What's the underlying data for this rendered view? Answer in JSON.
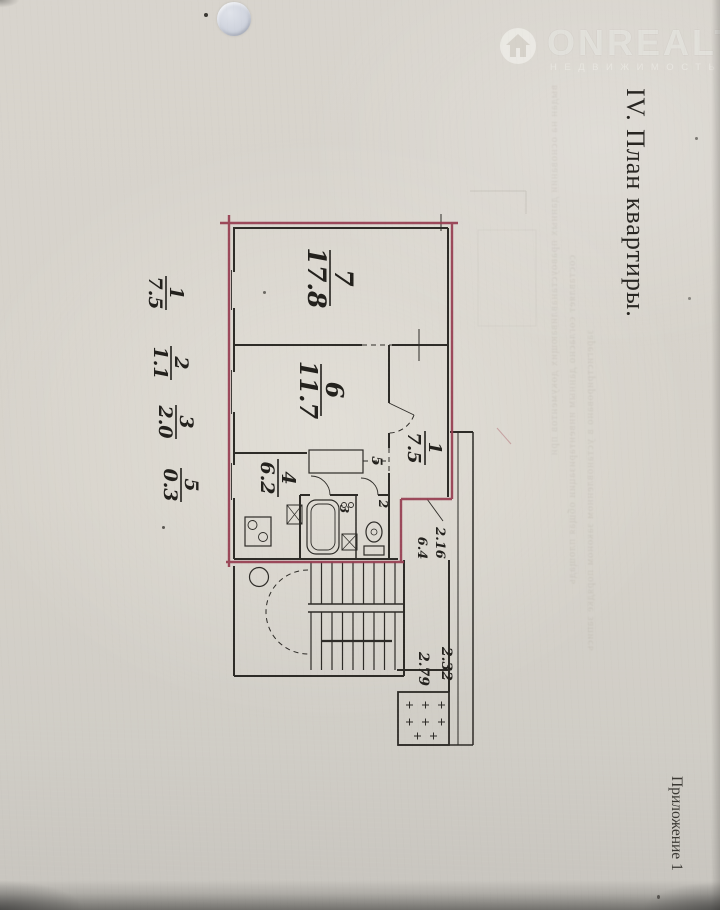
{
  "page": {
    "title": "IV. План квартиры.",
    "annex": "Приложение 1"
  },
  "watermark": {
    "brand": "ONREALT",
    "tagline": "НЕДВИЖИМОСТЬ",
    "icon": "house-in-circle",
    "color": "rgba(250,249,246,0.55)"
  },
  "margin_notes": {
    "fractions": [
      {
        "num": "1",
        "den": "7.5"
      },
      {
        "num": "2",
        "den": "1.1"
      },
      {
        "num": "3",
        "den": "2.0"
      },
      {
        "num": "5",
        "den": "0.3"
      }
    ]
  },
  "floor_plan": {
    "outline_color": "#963c50",
    "ink_color": "#2d2b27",
    "rooms": [
      {
        "name": "living-room",
        "num": "7",
        "area": "17.8"
      },
      {
        "name": "bedroom",
        "num": "6",
        "area": "11.7"
      },
      {
        "name": "kitchen",
        "num": "4",
        "area": "6.2"
      },
      {
        "name": "hallway",
        "num": "1",
        "area": "7.5"
      }
    ],
    "small_labels": {
      "closet": "5",
      "bath": "3",
      "wc": "2"
    },
    "handwritten_side_notes": [
      "2.16",
      "6.4"
    ],
    "handwritten_lift_notes": [
      "2.32",
      "2.79"
    ]
  },
  "bleedthrough": {
    "lines": [
      "выдан на основании данных правоустанавливающих документов при",
      "составляет согласно данным инвентаризации общая площадь",
      "зарегистрировано в установленном законом порядке запись"
    ]
  }
}
